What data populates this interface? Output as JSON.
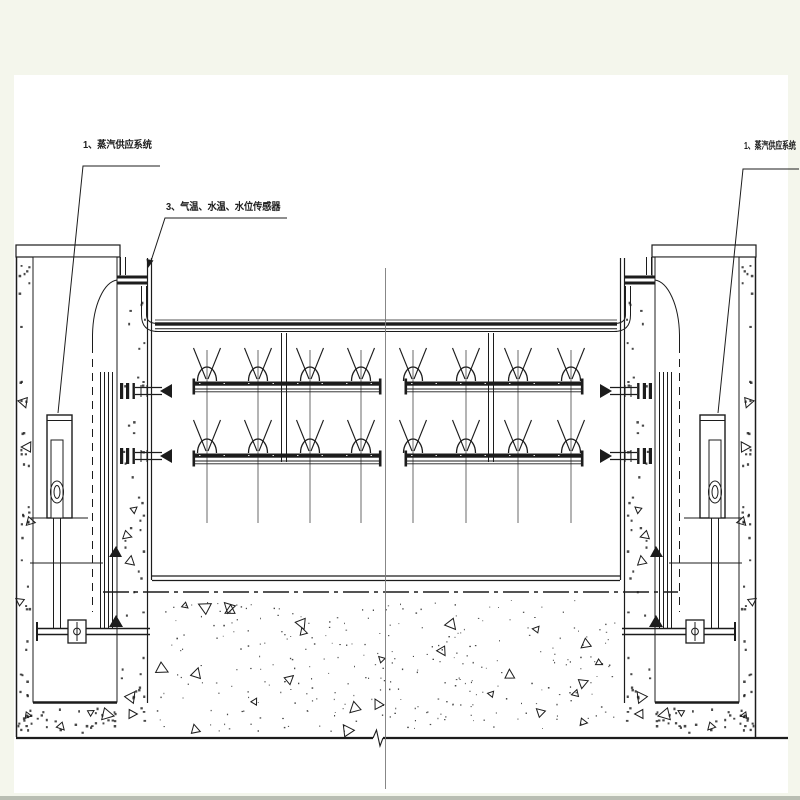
{
  "drawing": {
    "labels": {
      "steam_supply_left": "1、蒸汽供应系统",
      "sensors": "3、气温、水温、水位传感器",
      "steam_supply_right": "1、蒸汽供应系统"
    },
    "colors": {
      "ink": "#1c1c1c",
      "paper": "#ffffff",
      "margin": "#f4f6ec",
      "edge": "#b9beb3",
      "centerline": "#7a7a7a"
    }
  }
}
